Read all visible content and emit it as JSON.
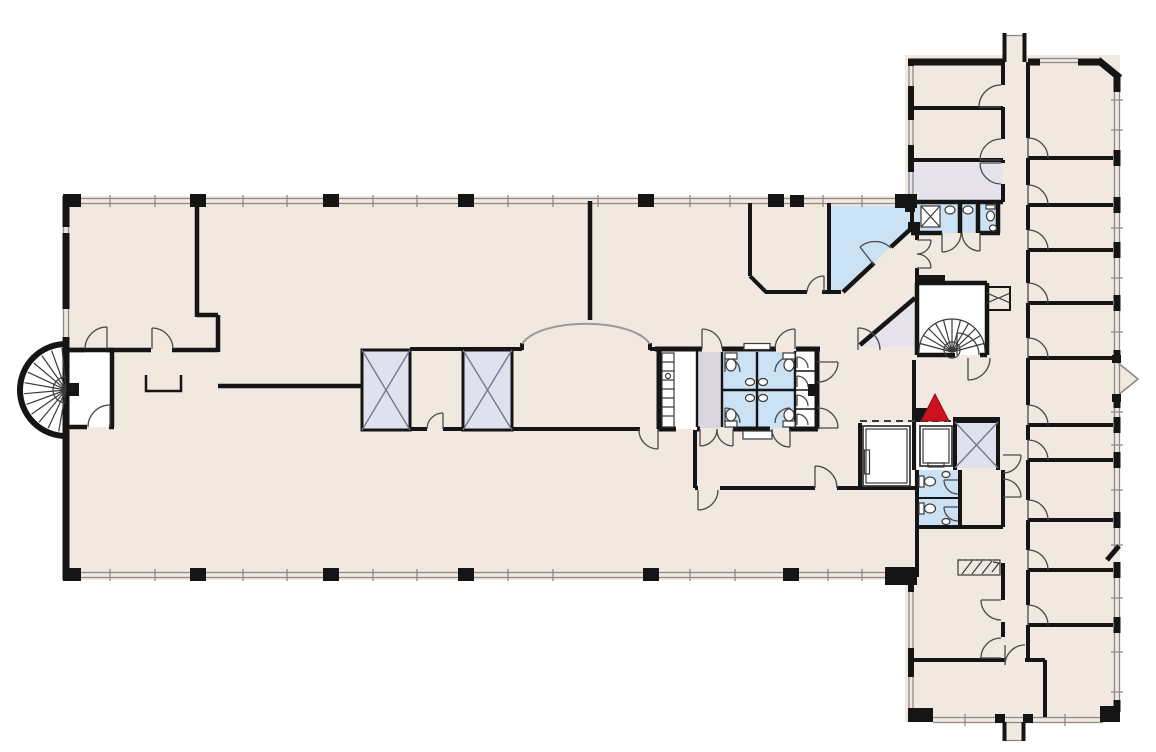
{
  "meta": {
    "title": "Building floor plan",
    "kind": "architectural-floor-plan",
    "visible_text": []
  },
  "canvas": {
    "width": 1156,
    "height": 752,
    "background": "#ffffff"
  },
  "colors": {
    "floor": "#f1e8df",
    "wall": "#151515",
    "room_white": "#ffffff",
    "wet_area": "#cbe2f4",
    "service_gray": "#e6e3ec",
    "vestibule_gray": "#d9d6df",
    "shaft_gray": "#dfe2ee",
    "shaft_line": "#77778a",
    "marker_red": "#ce1021",
    "marker_red_edge": "#8d0f1a",
    "door_line": "#4a4a4a",
    "glass_line": "#8a8a8a",
    "fixture_line": "#3a3a3a",
    "arch_line": "#9a9a9a"
  },
  "marker": {
    "name": "location-marker",
    "shape": "triangle-up",
    "color": "#ce1021",
    "x": 935,
    "y": 408
  },
  "features": [
    "open-office-hall",
    "spiral-staircase-west",
    "spiral-staircase-east",
    "elevator-large",
    "elevator-small",
    "elevator-shaft-x",
    "service-shaft-x2",
    "restroom-core-central",
    "restroom-north",
    "restroom-south",
    "break-room-triangle",
    "diagonal-corridor",
    "office-wing-corridor",
    "window-band",
    "arched-opening",
    "roof-exit-stub-north",
    "exit-vestibule-south",
    "window-bay-east"
  ]
}
